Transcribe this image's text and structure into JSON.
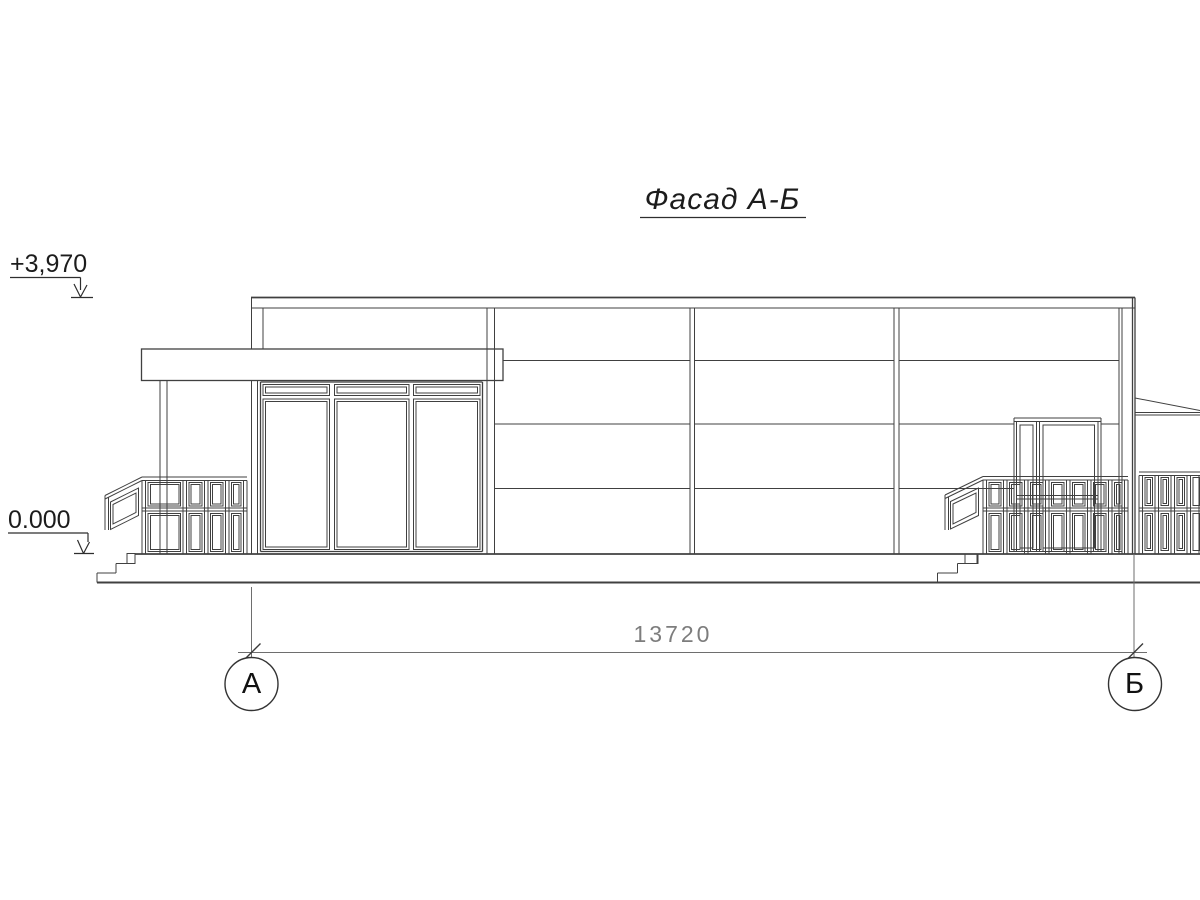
{
  "drawing_title": {
    "text": "Фасад А-Б"
  },
  "elevation_marks": {
    "top": "+3,970",
    "ground": "0.000"
  },
  "dimension": {
    "value": "13720"
  },
  "axes": {
    "left": "А",
    "right": "Б"
  },
  "colors": {
    "line": "#404040",
    "dimension_text": "#7d7d7d",
    "annotation_text": "#1c1c1c",
    "background": "#ffffff"
  }
}
